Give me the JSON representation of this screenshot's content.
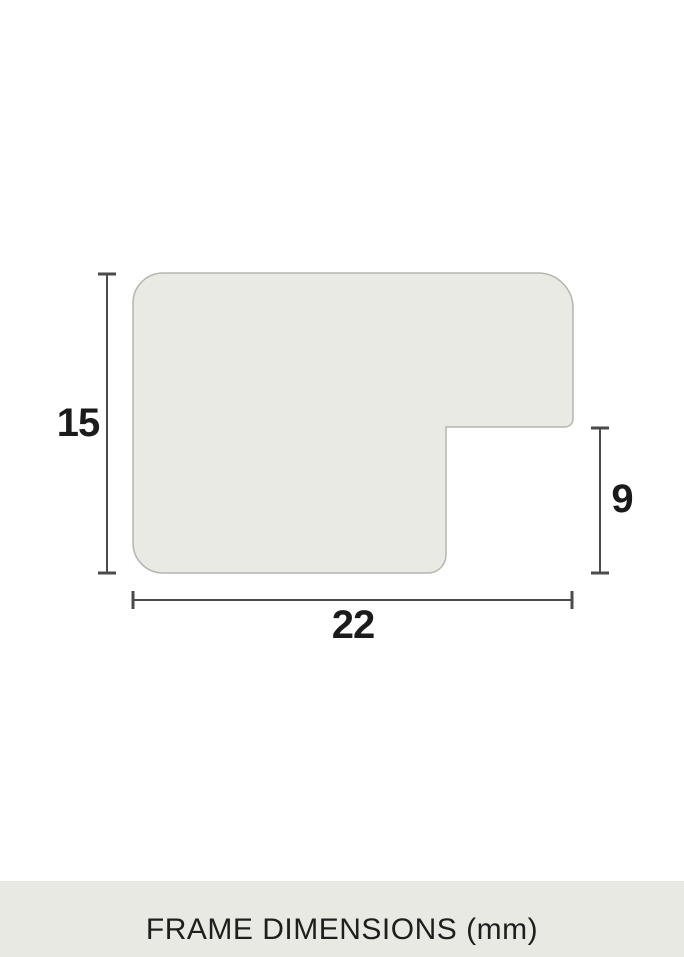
{
  "diagram": {
    "title": "frame-profile-cross-section",
    "labels": {
      "height": "15",
      "rabbet": "9",
      "width": "22"
    }
  },
  "footer": {
    "caption": "FRAME DIMENSIONS (mm)"
  },
  "colors": {
    "background": "#ffffff",
    "shape_fill": "#e9eae4",
    "shape_border": "#b4b5b0",
    "dimension_line": "#4b4b4b",
    "label_text": "#1b1b1b",
    "footer_bg": "#e9e9e3",
    "footer_text": "#1e1e1e"
  }
}
